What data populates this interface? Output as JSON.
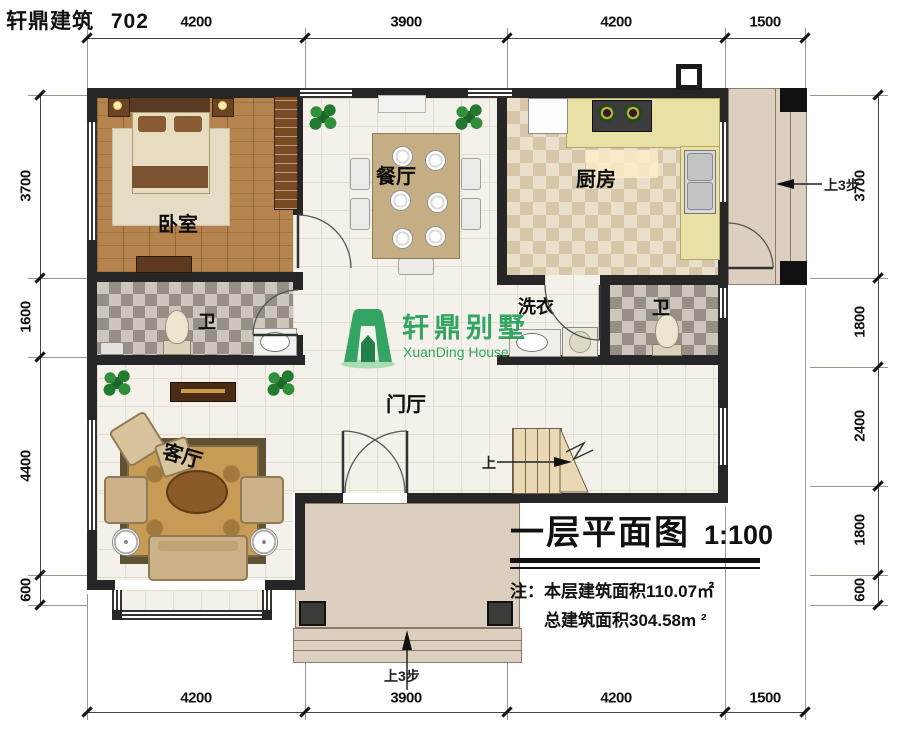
{
  "header": {
    "brand": "轩鼎建筑",
    "number": "702"
  },
  "dimensions": {
    "top": [
      "4200",
      "3900",
      "4200",
      "1500"
    ],
    "bottom": [
      "4200",
      "3900",
      "4200",
      "1500"
    ],
    "left": [
      "3700",
      "1600",
      "4400",
      "600"
    ],
    "right": [
      "3700",
      "1800",
      "2400",
      "1800",
      "600"
    ]
  },
  "rooms": {
    "bedroom": "卧室",
    "dining": "餐厅",
    "kitchen": "厨房",
    "bath_left": "卫",
    "bath_right": "卫",
    "laundry": "洗衣",
    "foyer": "门厅",
    "living": "客厅"
  },
  "annotations": {
    "up_steps_right": "上3步",
    "up_steps_bottom": "上3步",
    "stair_up": "上"
  },
  "logo": {
    "name_cn": "轩鼎别墅",
    "name_en": "XuanDing House",
    "color": "#2aa05c"
  },
  "title_block": {
    "title": "一层平面图",
    "scale": "1:100",
    "note_line1": "注：本层建筑面积110.07㎡",
    "note_line2": "总建筑面积304.58m ²"
  },
  "colors": {
    "wall": "#262626",
    "accent_green": "#2aa05c",
    "wood_floor": "#b5834e",
    "porch": "#ddcfbf"
  }
}
